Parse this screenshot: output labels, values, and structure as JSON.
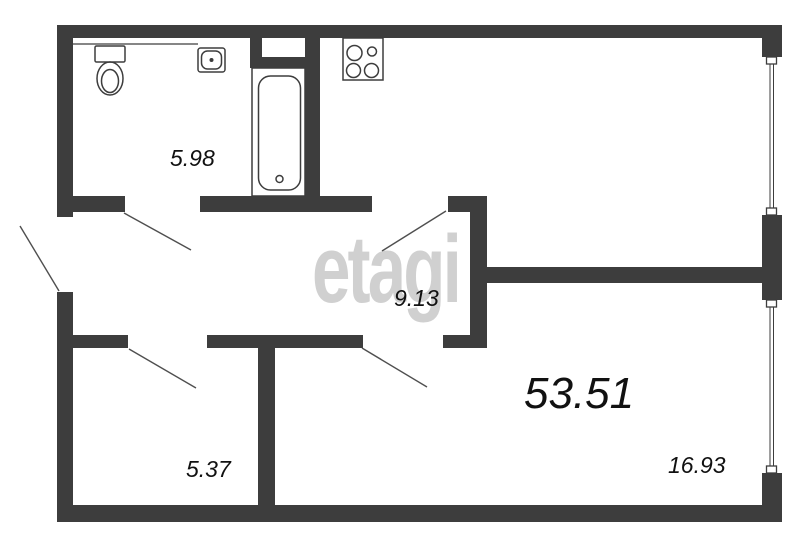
{
  "floorplan": {
    "watermark": "etagi",
    "total_area_label": "53.51",
    "room_labels": [
      {
        "id": "bathroom",
        "area": "5.98"
      },
      {
        "id": "hallway",
        "area": "9.13"
      },
      {
        "id": "small-room",
        "area": "5.37"
      },
      {
        "id": "living-room",
        "area": "16.93"
      }
    ],
    "colors": {
      "wall": "#3d3d3d",
      "line": "#4f4f4f",
      "label_text": "#111111",
      "watermark": "#919191",
      "background": "#ffffff"
    },
    "icons": [
      "toilet-icon",
      "sink-icon",
      "bathtub-icon",
      "stove-icon",
      "window-icon",
      "door-swing-icon"
    ]
  }
}
